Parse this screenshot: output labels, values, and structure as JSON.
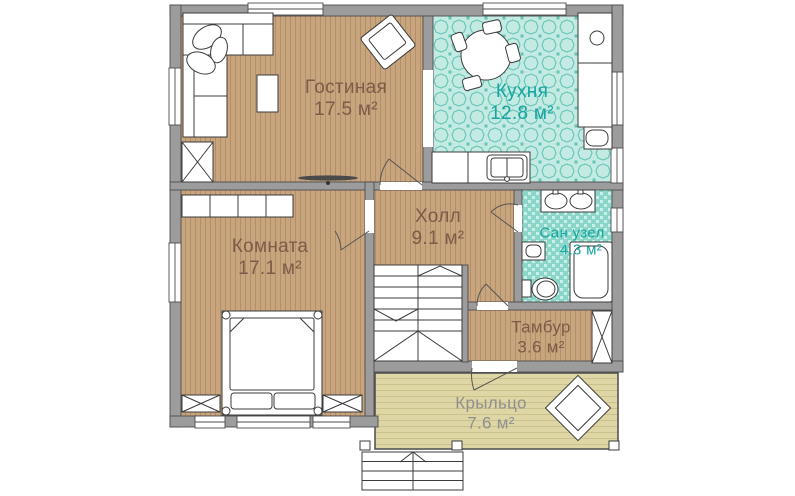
{
  "rooms": [
    {
      "name": "Гостиная",
      "area": "17.5 м²"
    },
    {
      "name": "Кухня",
      "area": "12.8 м²"
    },
    {
      "name": "Комната",
      "area": "17.1 м²"
    },
    {
      "name": "Холл",
      "area": "9.1 м²"
    },
    {
      "name": "Сан узел",
      "area": "4.3 м²"
    },
    {
      "name": "Тамбур",
      "area": "3.6 м²"
    },
    {
      "name": "Крыльцо",
      "area": "7.6 м²"
    }
  ],
  "colors": {
    "wood_floor": "#c8a57d",
    "kitchen_tile_floor": "#c3ebe3",
    "bath_tile_floor": "#8ad7ca",
    "porch_floor": "#ded6a4",
    "wall_gray": "#9c9c9c",
    "label_brown": "#7d5b49",
    "label_teal": "#16a5a0",
    "label_gray": "#8f8f8f"
  }
}
